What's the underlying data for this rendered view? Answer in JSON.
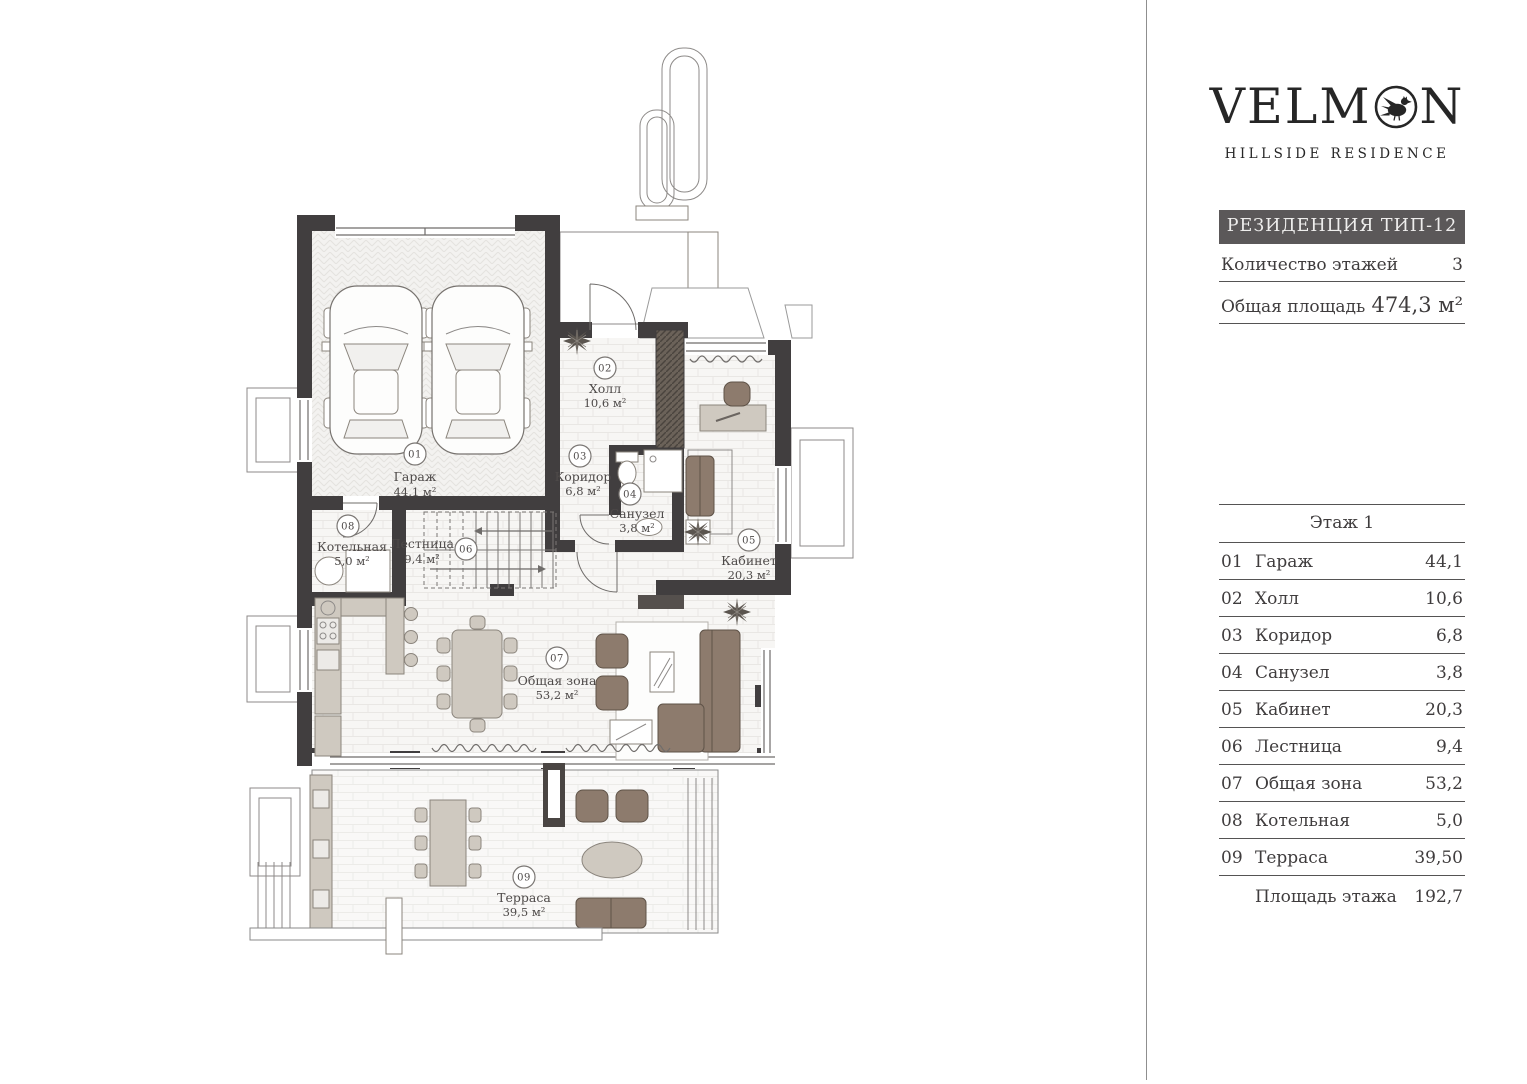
{
  "brand": {
    "logo_left": "VELM",
    "logo_right": "N",
    "subtitle": "HILLSIDE RESIDENCE"
  },
  "info_panel": {
    "title": "РЕЗИДЕНЦИЯ ТИП-12",
    "rows": [
      {
        "label": "Количество этажей",
        "value": "3"
      },
      {
        "label": "Общая площадь",
        "value": "474,3 м²"
      }
    ]
  },
  "floor_table": {
    "title": "Этаж 1",
    "rows": [
      {
        "num": "01",
        "name": "Гараж",
        "area": "44,1"
      },
      {
        "num": "02",
        "name": "Холл",
        "area": "10,6"
      },
      {
        "num": "03",
        "name": "Коридор",
        "area": "6,8"
      },
      {
        "num": "04",
        "name": "Санузел",
        "area": "3,8"
      },
      {
        "num": "05",
        "name": "Кабинет",
        "area": "20,3"
      },
      {
        "num": "06",
        "name": "Лестница",
        "area": "9,4"
      },
      {
        "num": "07",
        "name": "Общая зона",
        "area": "53,2"
      },
      {
        "num": "08",
        "name": "Котельная",
        "area": "5,0"
      },
      {
        "num": "09",
        "name": "Терраса",
        "area": "39,50"
      }
    ],
    "total_label": "Площадь этажа",
    "total_value": "192,7"
  },
  "plan": {
    "rooms": [
      {
        "num": "01",
        "name": "Гараж",
        "area": "44,1 м²"
      },
      {
        "num": "02",
        "name": "Холл",
        "area": "10,6 м²"
      },
      {
        "num": "03",
        "name": "Коридор",
        "area": "6,8 м²"
      },
      {
        "num": "04",
        "name": "Санузел",
        "area": "3,8 м²"
      },
      {
        "num": "05",
        "name": "Кабинет",
        "area": "20,3 м²"
      },
      {
        "num": "06",
        "name": "Лестница",
        "area": "9,4 м²"
      },
      {
        "num": "07",
        "name": "Общая зона",
        "area": "53,2 м²"
      },
      {
        "num": "08",
        "name": "Котельная",
        "area": "5,0 м²"
      },
      {
        "num": "09",
        "name": "Терраса",
        "area": "39,5 м²"
      }
    ]
  },
  "colors": {
    "wall": "#413e3f",
    "panel_header_bg": "#5b5859",
    "furniture_brown": "#8d7b6d",
    "furniture_beige": "#cfc9c0",
    "line": "#555353"
  }
}
